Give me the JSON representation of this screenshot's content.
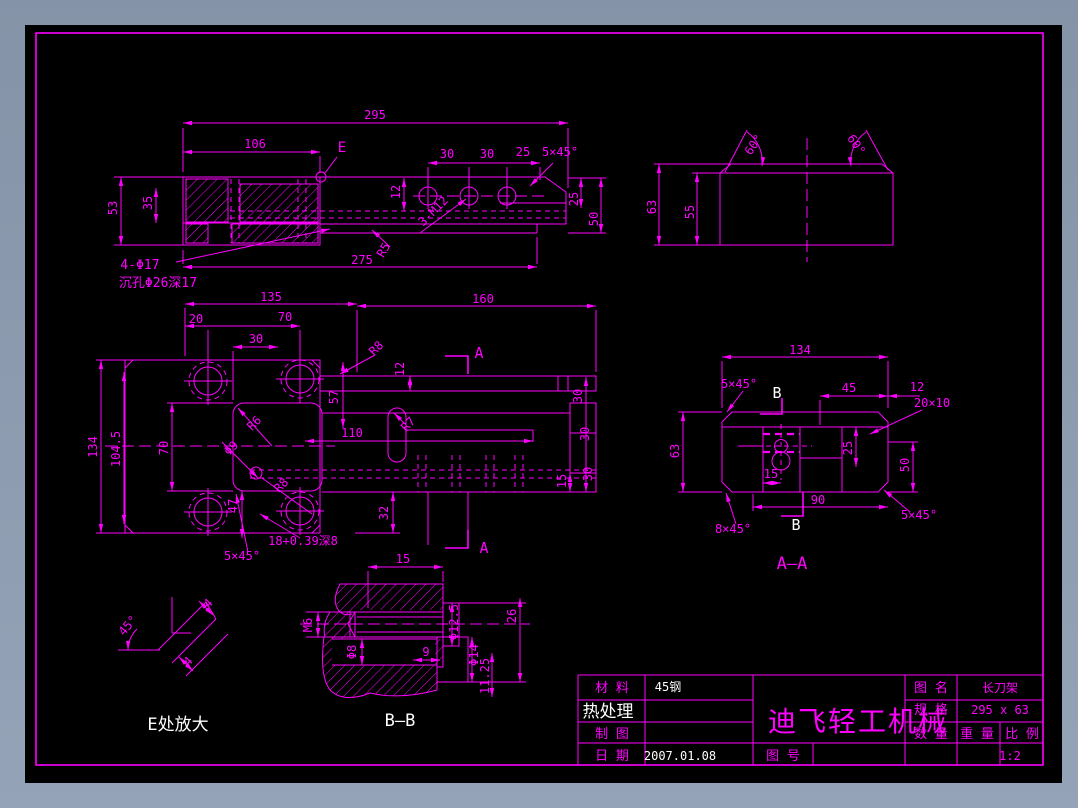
{
  "app": {
    "desktop_color": "#8d9bb0",
    "sheet_color": "#000000",
    "line_color": "#ff00ff",
    "alt_text_color": "#ffffff"
  },
  "views": {
    "top_view": {
      "labels": [
        "295",
        "106",
        "E",
        "30",
        "30",
        "25",
        "5×45°",
        "12",
        "53",
        "35",
        "3-M12",
        "25",
        "50",
        "275",
        "R5",
        "4-Φ17",
        "沉孔Φ26深17"
      ]
    },
    "side_view": {
      "labels": [
        "60°",
        "60°",
        "63",
        "55"
      ]
    },
    "plan_view": {
      "labels": [
        "135",
        "20",
        "70",
        "30",
        "160",
        "R8",
        "12",
        "A",
        "A",
        "57",
        "134",
        "104.5",
        "70",
        "R7",
        "110",
        "R6",
        "Φ9",
        "R8",
        "47",
        "30",
        "30",
        "30",
        "15",
        "32",
        "18+0.39深8",
        "5×45°"
      ]
    },
    "section_aa": {
      "labels": [
        "134",
        "5×45°",
        "B",
        "45",
        "12",
        "20×10",
        "63",
        "25",
        "50",
        "15",
        "90",
        "B",
        "5×45°",
        "8×45°"
      ],
      "title": "A—A"
    },
    "section_bb": {
      "labels": [
        "15",
        "M6",
        "Φ12.5",
        "26",
        "Φ8",
        "9",
        "Φ14",
        "11.25"
      ],
      "title": "B—B"
    },
    "detail_e": {
      "labels": [
        "45°",
        "4",
        "4"
      ],
      "title": "E处放大"
    }
  },
  "title_block": {
    "material_label": "材 料",
    "material_value": "45钢",
    "heat_label": "热处理",
    "draft_label": "制 图",
    "date_label": "日 期",
    "date_value": "2007.01.08",
    "company": "迪飞轻工机械",
    "drawing_no_label": "图 号",
    "name_label": "图 名",
    "name_value": "长刀架",
    "spec_label": "规 格",
    "spec_value": "295 x 63",
    "qty_label": "数 量",
    "weight_label": "重 量",
    "scale_label": "比 例",
    "scale_value": "1:2"
  }
}
